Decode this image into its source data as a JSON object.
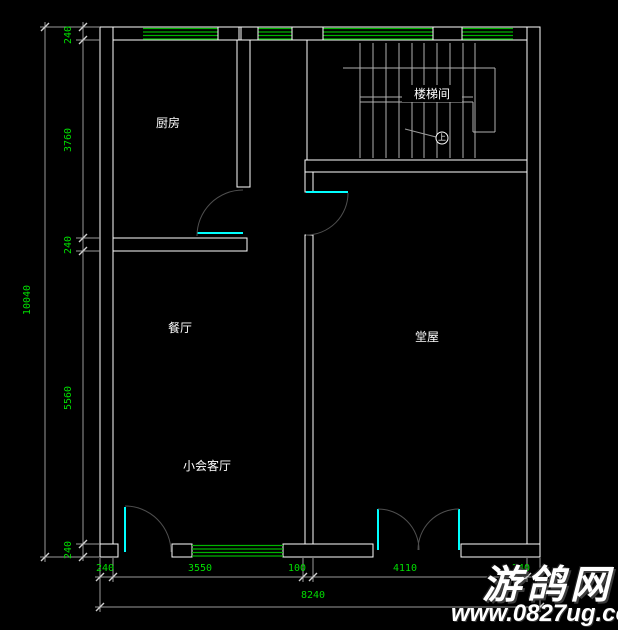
{
  "colors": {
    "bg": "#000000",
    "wall": "#ffffff",
    "win": "#00b400",
    "door": "#00ffff",
    "arc": "#4f4f4f",
    "dim": "#9a9a9a",
    "dimtext": "#00de00",
    "stair": "#b0b0b0",
    "wm": "#ffffff"
  },
  "rooms": {
    "kitchen": "厨房",
    "stairwell": "楼梯间",
    "dining": "餐厅",
    "hall": "堂屋",
    "parlor": "小会客厅",
    "up_symbol": "上"
  },
  "dimensions": {
    "left": {
      "segments": [
        "240",
        "3760",
        "240",
        "5560",
        "240"
      ],
      "total": "10040"
    },
    "bottom": {
      "segments": [
        "240",
        "3550",
        "100",
        "4110",
        "240"
      ],
      "total": "8240"
    }
  },
  "watermark": {
    "name": "游鸽网",
    "url": "www.0827ug.com"
  }
}
